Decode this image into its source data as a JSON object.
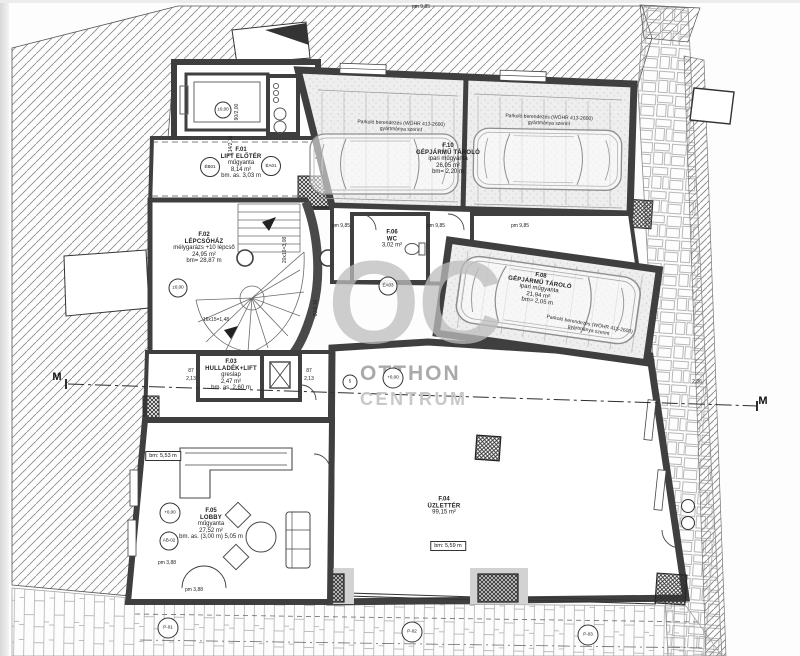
{
  "watermark": {
    "oc": "OC",
    "line1": "OTTHON",
    "line2": "CENTRUM"
  },
  "colors": {
    "wall": "#3f3f3f",
    "hatch_line": "#777777",
    "garage_floor": "#ededed",
    "watermark_oc": "#bdbdbd",
    "watermark_otthon": "#9c9c9c",
    "watermark_centrum": "#c6c6c6"
  },
  "rooms": [
    {
      "x": 241,
      "y": 163,
      "rot": 0,
      "lines": [
        "F.01",
        "LIFT ELŐTÉR",
        "műgyanta",
        "8,14 m²",
        "bm. as. 3,03 m"
      ]
    },
    {
      "x": 204,
      "y": 248,
      "rot": 0,
      "lines": [
        "F.02",
        "LÉPCSŐHÁZ",
        "mélygarázs +10 lépcső",
        "24,95 m²",
        "bm= 28,87 m"
      ]
    },
    {
      "x": 231,
      "y": 375,
      "rot": 0,
      "lines": [
        "F.03",
        "HULLADÉK+LIFT",
        "greslap",
        "2,47 m²",
        "bm. as. 2,60 m"
      ]
    },
    {
      "x": 392,
      "y": 239,
      "rot": 0,
      "lines": [
        "F.06",
        "WC",
        "3,02 m²"
      ]
    },
    {
      "x": 448,
      "y": 159,
      "rot": 0,
      "lines": [
        "F.10",
        "GÉPJÁRMŰ TÁROLÓ",
        "ipari műgyanta",
        "26,05 m²",
        "bm= 2,20 m"
      ]
    },
    {
      "x": 539,
      "y": 289,
      "rot": 8,
      "lines": [
        "F.08",
        "GÉPJÁRMŰ TÁROLÓ",
        "ipari műgyanta",
        "21,94 m²",
        "bm= 2,05 m"
      ]
    },
    {
      "x": 444,
      "y": 506,
      "rot": 0,
      "lines": [
        "F.04",
        "ÜZLETTÉR",
        "99,15 m²"
      ]
    },
    {
      "x": 211,
      "y": 524,
      "rot": 0,
      "lines": [
        "F.05",
        "LOBBY",
        "műgyanta",
        "27,52 m²",
        "bm. as. (3,00 m) 5,05 m"
      ]
    }
  ],
  "notes": [
    {
      "x": 401,
      "y": 127,
      "rot": 2,
      "lines": [
        "Parkoló berendezés (WÖHR 413-2600)",
        "gyártmánya szerint"
      ]
    },
    {
      "x": 549,
      "y": 121,
      "rot": 2,
      "lines": [
        "Parkoló berendezés (WÖHR 413-2600)",
        "gyártmánya szerint"
      ]
    },
    {
      "x": 589,
      "y": 328,
      "rot": 10,
      "lines": [
        "Parkoló berendezés (WÖHR 413-2600)",
        "gyártmánya szerint"
      ]
    }
  ],
  "dims": [
    {
      "t": "pm 9,85",
      "x": 421,
      "y": 7,
      "rot": 0
    },
    {
      "t": "pm 9,85",
      "x": 341,
      "y": 226,
      "rot": 0
    },
    {
      "t": "pm 9,85",
      "x": 436,
      "y": 226,
      "rot": 0
    },
    {
      "t": "pm 9,85",
      "x": 520,
      "y": 226,
      "rot": 0
    },
    {
      "t": "pm 3,88",
      "x": 167,
      "y": 563,
      "rot": 0
    },
    {
      "t": "pm 3,88",
      "x": 194,
      "y": 590,
      "rot": 0
    },
    {
      "t": "16x15=1,48",
      "x": 216,
      "y": 320,
      "rot": 0
    },
    {
      "t": "20x16=3,08",
      "x": 285,
      "y": 250,
      "rot": -90
    },
    {
      "t": "90/2,00",
      "x": 237,
      "y": 112,
      "rot": -90
    },
    {
      "t": "1,14/2,16",
      "x": 231,
      "y": 146,
      "rot": -90
    },
    {
      "t": "87",
      "x": 191,
      "y": 371,
      "rot": 0
    },
    {
      "t": "2,13",
      "x": 191,
      "y": 379,
      "rot": 0
    },
    {
      "t": "87",
      "x": 309,
      "y": 371,
      "rot": 0
    },
    {
      "t": "2,13",
      "x": 309,
      "y": 379,
      "rot": 0
    },
    {
      "t": "60/2,10",
      "x": 316,
      "y": 308,
      "rot": -90
    },
    {
      "t": "2,36",
      "x": 697,
      "y": 382,
      "rot": 0
    }
  ],
  "section_markers": [
    {
      "t": "M",
      "x": 57,
      "y": 377
    },
    {
      "t": "M",
      "x": 763,
      "y": 401
    }
  ],
  "circle_markers": [
    {
      "t": "ÉB01",
      "x": 210,
      "y": 167,
      "s": 18
    },
    {
      "t": "ÉA01",
      "x": 271,
      "y": 166,
      "s": 18
    },
    {
      "t": "±0,00",
      "x": 223,
      "y": 110,
      "s": 15
    },
    {
      "t": "±0,00",
      "x": 178,
      "y": 288,
      "s": 17
    },
    {
      "t": "+0,00",
      "x": 170,
      "y": 513,
      "s": 19
    },
    {
      "t": "AB-02",
      "x": 169,
      "y": 541,
      "s": 17
    },
    {
      "t": "+0,00",
      "x": 393,
      "y": 378,
      "s": 19
    },
    {
      "t": "ÉA03",
      "x": 388,
      "y": 286,
      "s": 17
    },
    {
      "t": "5",
      "x": 350,
      "y": 382,
      "s": 13
    },
    {
      "t": "P-01",
      "x": 168,
      "y": 628,
      "s": 19
    },
    {
      "t": "P-02",
      "x": 412,
      "y": 632,
      "s": 19
    },
    {
      "t": "P-03",
      "x": 588,
      "y": 635,
      "s": 19
    },
    {
      "t": "",
      "x": 688,
      "y": 506,
      "s": 12
    },
    {
      "t": "",
      "x": 688,
      "y": 523,
      "s": 12
    }
  ],
  "boxed_labels": [
    {
      "t": "bm: 5,59 m",
      "x": 448,
      "y": 546
    },
    {
      "t": "bm: 5,53 m",
      "x": 163,
      "y": 456
    }
  ]
}
